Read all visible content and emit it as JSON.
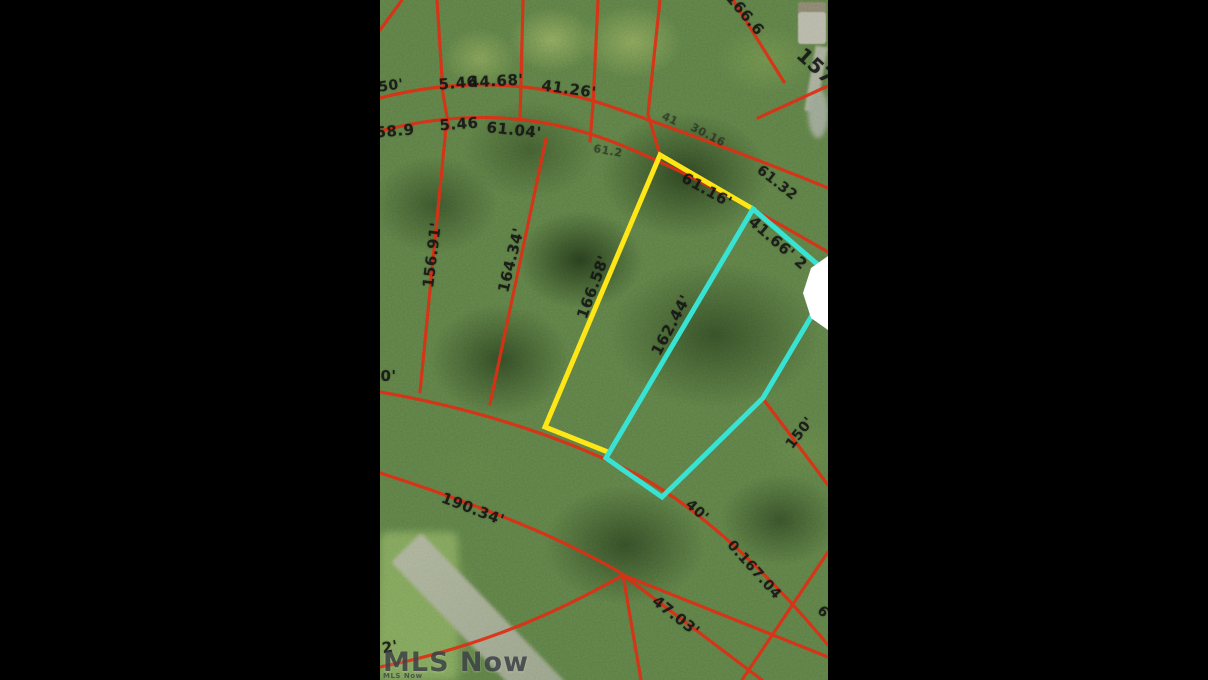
{
  "colors": {
    "parcel_line_red": "#dd2f14",
    "highlight_lot_yellow": "#ffe616",
    "highlight_lot_cyan": "#38e3d4",
    "measurement_text": "#141414",
    "watermark_text": "#3d4246"
  },
  "watermark": {
    "main": "MLS Now",
    "small": "MLS Now"
  },
  "photo": {
    "kind": "aerial-parcel-map",
    "measurements": [
      {
        "text": "50'",
        "x": 11,
        "y": 86,
        "rot": -8,
        "size": 14,
        "dim": false
      },
      {
        "text": "5.46",
        "x": 78,
        "y": 83,
        "rot": -5,
        "size": 15,
        "dim": false
      },
      {
        "text": "44.68'",
        "x": 116,
        "y": 81,
        "rot": -3,
        "size": 15,
        "dim": false
      },
      {
        "text": "41.26'",
        "x": 189,
        "y": 89,
        "rot": 8,
        "size": 15,
        "dim": false
      },
      {
        "text": "166.6",
        "x": 365,
        "y": 14,
        "rot": 50,
        "size": 15,
        "dim": false
      },
      {
        "text": "157",
        "x": 436,
        "y": 66,
        "rot": 42,
        "size": 20,
        "dim": false
      },
      {
        "text": "58.9",
        "x": 15,
        "y": 131,
        "rot": -5,
        "size": 15,
        "dim": false
      },
      {
        "text": "5.46",
        "x": 79,
        "y": 124,
        "rot": -4,
        "size": 15,
        "dim": false
      },
      {
        "text": "61.04'",
        "x": 134,
        "y": 130,
        "rot": 6,
        "size": 15,
        "dim": false
      },
      {
        "text": "41",
        "x": 290,
        "y": 119,
        "rot": 25,
        "size": 11,
        "dim": true
      },
      {
        "text": "30.16",
        "x": 328,
        "y": 135,
        "rot": 27,
        "size": 11,
        "dim": true
      },
      {
        "text": "61.2",
        "x": 228,
        "y": 151,
        "rot": 10,
        "size": 11,
        "dim": true
      },
      {
        "text": "61.32",
        "x": 397,
        "y": 183,
        "rot": 38,
        "size": 14,
        "dim": false
      },
      {
        "text": "156.91'",
        "x": 52,
        "y": 255,
        "rot": -83,
        "size": 15,
        "dim": false
      },
      {
        "text": "164.34'",
        "x": 131,
        "y": 260,
        "rot": -76,
        "size": 15,
        "dim": false
      },
      {
        "text": "166.58'",
        "x": 213,
        "y": 287,
        "rot": -70,
        "size": 15,
        "dim": false
      },
      {
        "text": "162.44'",
        "x": 291,
        "y": 325,
        "rot": -62,
        "size": 15,
        "dim": false
      },
      {
        "text": "61.16'",
        "x": 327,
        "y": 190,
        "rot": 29,
        "size": 15,
        "dim": false
      },
      {
        "text": "41.66' 2",
        "x": 398,
        "y": 243,
        "rot": 41,
        "size": 15,
        "dim": false
      },
      {
        "text": "40'",
        "x": 3,
        "y": 376,
        "rot": 0,
        "size": 15,
        "dim": false
      },
      {
        "text": "190.34'",
        "x": 93,
        "y": 509,
        "rot": 21,
        "size": 15,
        "dim": false
      },
      {
        "text": "40'",
        "x": 317,
        "y": 511,
        "rot": 42,
        "size": 14,
        "dim": false
      },
      {
        "text": "0.167.04",
        "x": 374,
        "y": 570,
        "rot": 48,
        "size": 14,
        "dim": false
      },
      {
        "text": "6",
        "x": 443,
        "y": 612,
        "rot": 45,
        "size": 14,
        "dim": false
      },
      {
        "text": "47.03'",
        "x": 296,
        "y": 616,
        "rot": 38,
        "size": 15,
        "dim": false
      },
      {
        "text": "150'",
        "x": 420,
        "y": 433,
        "rot": -52,
        "size": 14,
        "dim": false
      },
      {
        "text": "2'",
        "x": 10,
        "y": 647,
        "rot": -10,
        "size": 15,
        "dim": false
      }
    ]
  }
}
